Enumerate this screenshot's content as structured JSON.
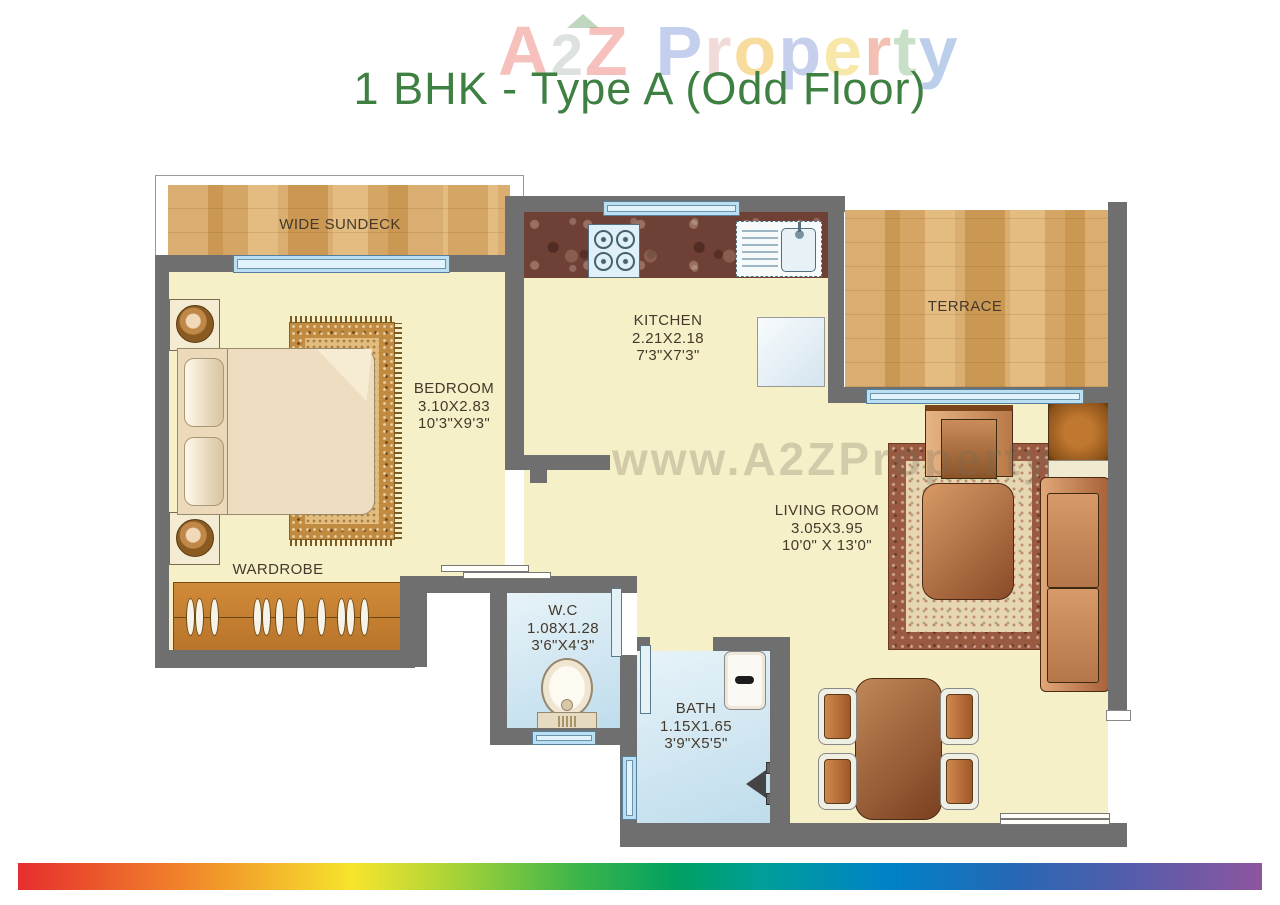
{
  "title": "1 BHK - Type A (Odd Floor)",
  "watermark": {
    "letters": [
      "A",
      "2",
      "Z",
      "P",
      "r",
      "o",
      "p",
      "e",
      "r",
      "t",
      "y"
    ],
    "center": "www.A2ZProperty"
  },
  "rooms": {
    "sundeck": {
      "name": "WIDE SUNDECK"
    },
    "bedroom": {
      "name": "BEDROOM",
      "dim_m": "3.10X2.83",
      "dim_ft": "10'3\"X9'3\""
    },
    "kitchen": {
      "name": "KITCHEN",
      "dim_m": "2.21X2.18",
      "dim_ft": "7'3\"X7'3\""
    },
    "terrace": {
      "name": "TERRACE"
    },
    "living_room": {
      "name": "LIVING ROOM",
      "dim_m": "3.05X3.95",
      "dim_ft": "10'0\" X 13'0\""
    },
    "wardrobe": {
      "name": "WARDROBE"
    },
    "wc": {
      "name": "W.C",
      "dim_m": "1.08X1.28",
      "dim_ft": "3'6\"X4'3\""
    },
    "bath": {
      "name": "BATH",
      "dim_m": "1.15X1.65",
      "dim_ft": "3'9\"X5'5\""
    }
  },
  "colors": {
    "title_green": "#3e7f42",
    "wall_gray": "#6f6f6f",
    "floor_cream": "#f6f0c9",
    "wet_floor_blue": "#cfe7f2",
    "window_blue": "#badff2",
    "brick_tan": "#dcab63",
    "counter_granite": "#6e4036",
    "wood_orange": "#c0802f",
    "rainbow": [
      "#e62e2e",
      "#f0822a",
      "#f6e52c",
      "#a8d338",
      "#3cb54a",
      "#00a062",
      "#009e9b",
      "#0082c8",
      "#2668b4",
      "#8e559e"
    ]
  }
}
